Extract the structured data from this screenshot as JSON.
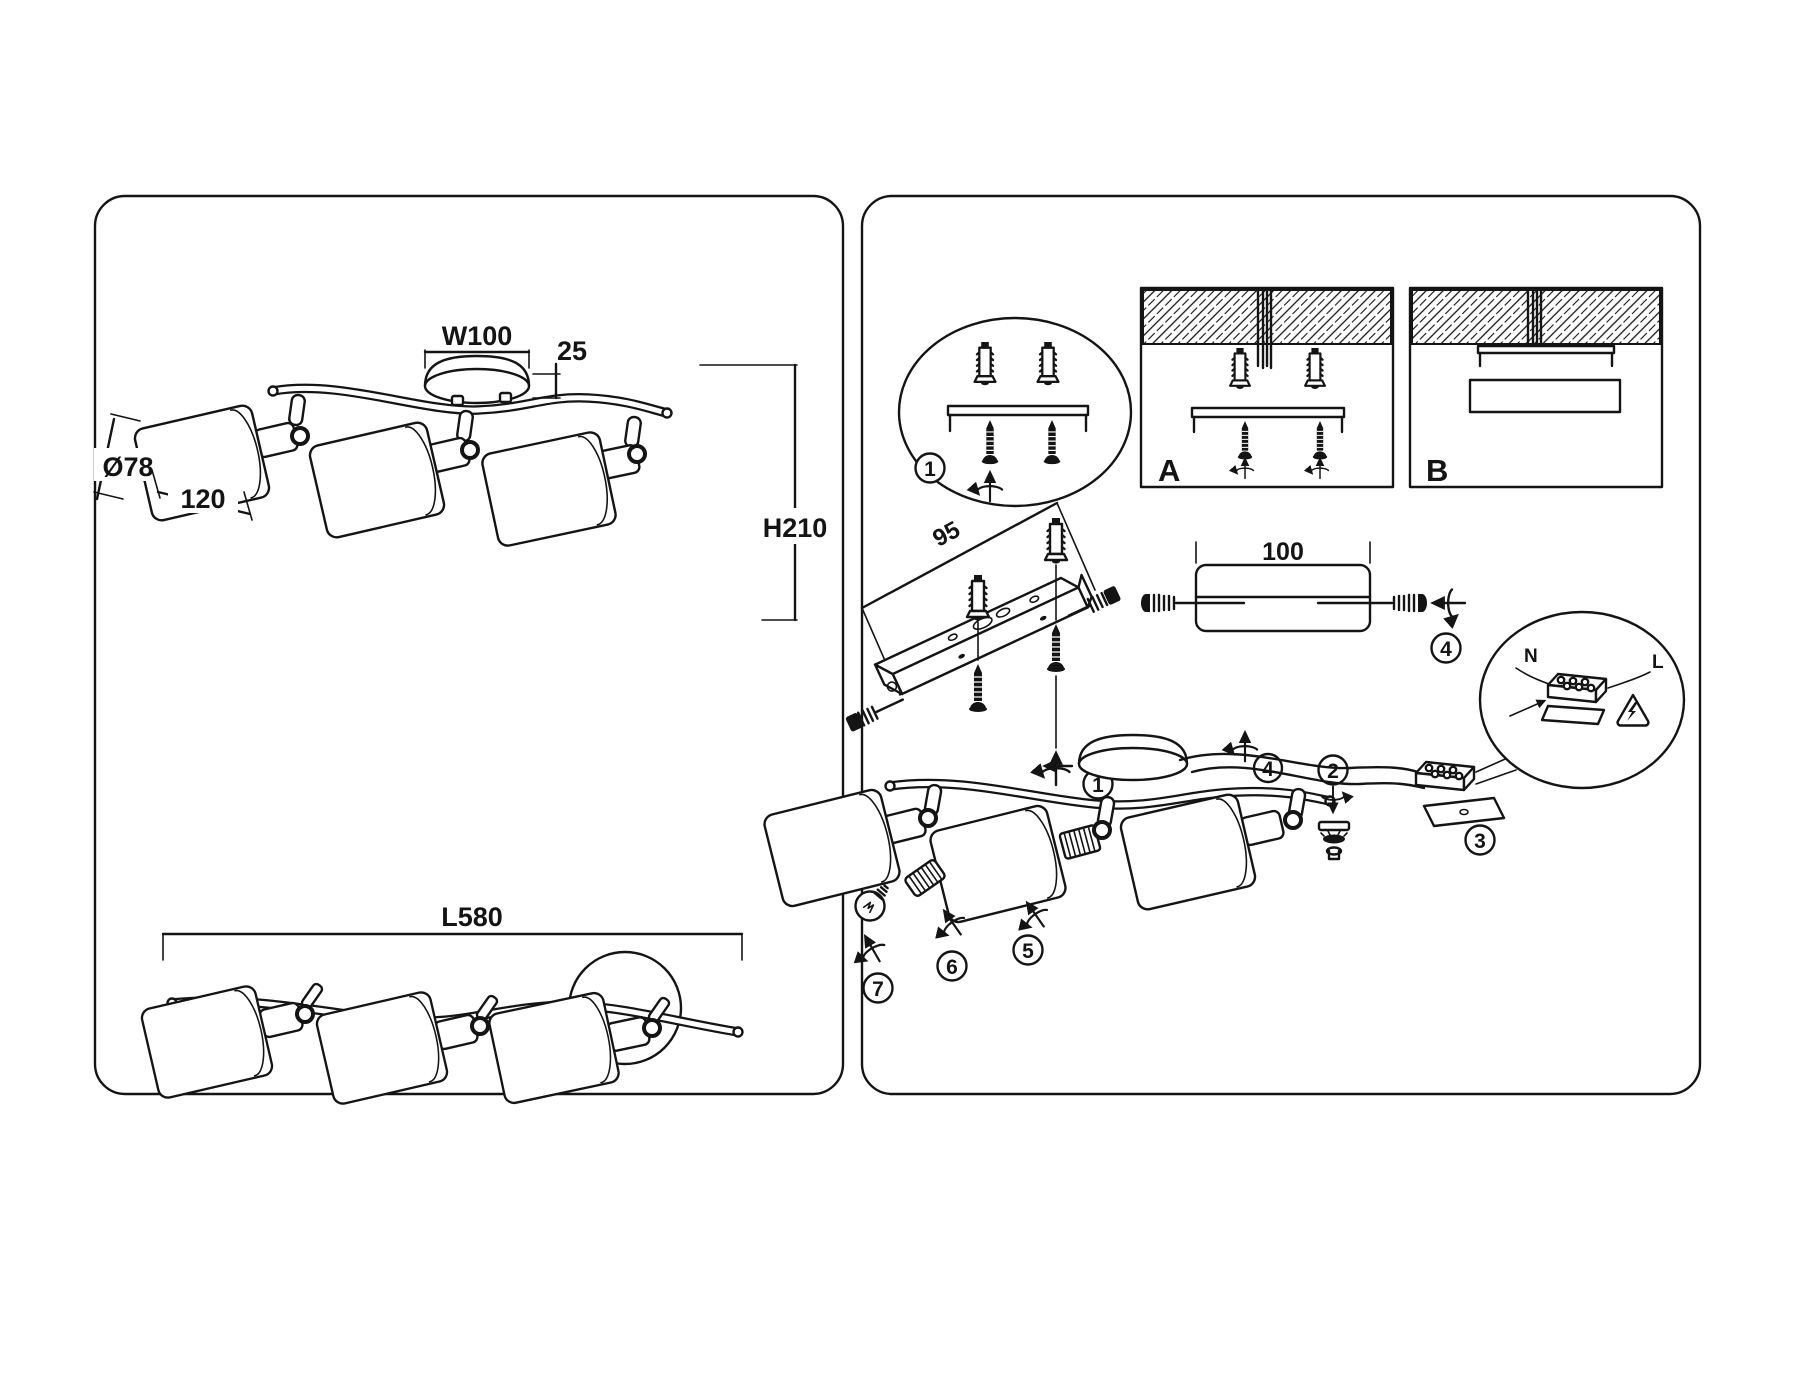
{
  "page": {
    "bg": "#ffffff",
    "ink": "#141414"
  },
  "left": {
    "side_view": {
      "w": "W100",
      "canopy_h": "25",
      "dia": "Ø78",
      "shade_len": "120",
      "h": "H210"
    },
    "top_view": {
      "len": "L580"
    }
  },
  "right": {
    "steps": {
      "s1": "1",
      "s2": "2",
      "s3": "3",
      "s4": "4",
      "s5": "5",
      "s6": "6",
      "s7": "7"
    },
    "options": {
      "a": "A",
      "b": "B"
    },
    "dims": {
      "bracket": "95",
      "connector": "100"
    },
    "wiring": {
      "n": "N",
      "l": "L"
    }
  }
}
